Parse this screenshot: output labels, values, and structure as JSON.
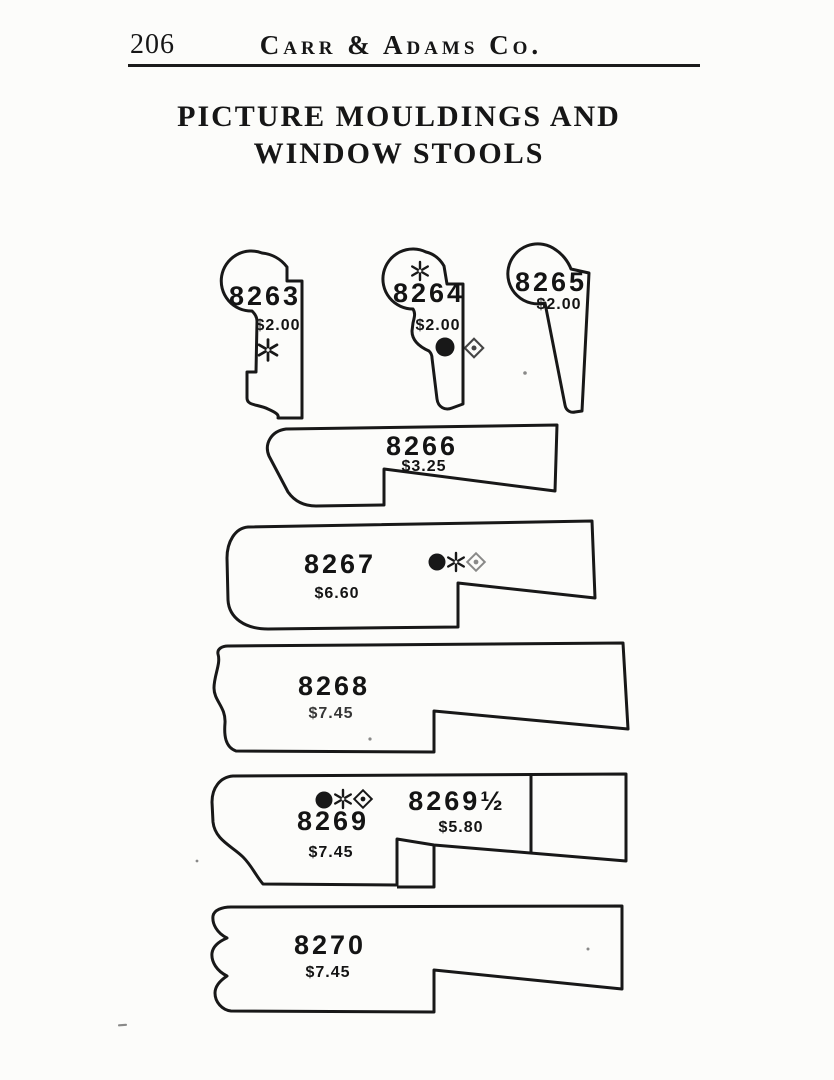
{
  "page": {
    "number": "206",
    "company": "Carr & Adams Co.",
    "title_line1": "PICTURE MOULDINGS AND",
    "title_line2": "WINDOW STOOLS"
  },
  "colors": {
    "ink": "#181818",
    "paper": "#fcfcfa"
  },
  "mouldings": [
    {
      "number": "8263",
      "price": "$2.00",
      "symbols": [
        "asterisk"
      ]
    },
    {
      "number": "8264",
      "price": "$2.00",
      "symbols": [
        "asterisk",
        "dot",
        "diamond"
      ]
    },
    {
      "number": "8265",
      "price": "$2.00",
      "symbols": []
    },
    {
      "number": "8266",
      "price": "$3.25",
      "symbols": []
    },
    {
      "number": "8267",
      "price": "$6.60",
      "symbols": [
        "dot",
        "asterisk",
        "diamond"
      ]
    },
    {
      "number": "8268",
      "price": "$7.45",
      "symbols": []
    },
    {
      "number": "8269",
      "price": "$7.45",
      "symbols": [
        "dot",
        "asterisk",
        "diamond"
      ]
    },
    {
      "number": "8269½",
      "price": "$5.80",
      "symbols": []
    },
    {
      "number": "8270",
      "price": "$7.45",
      "symbols": []
    }
  ]
}
